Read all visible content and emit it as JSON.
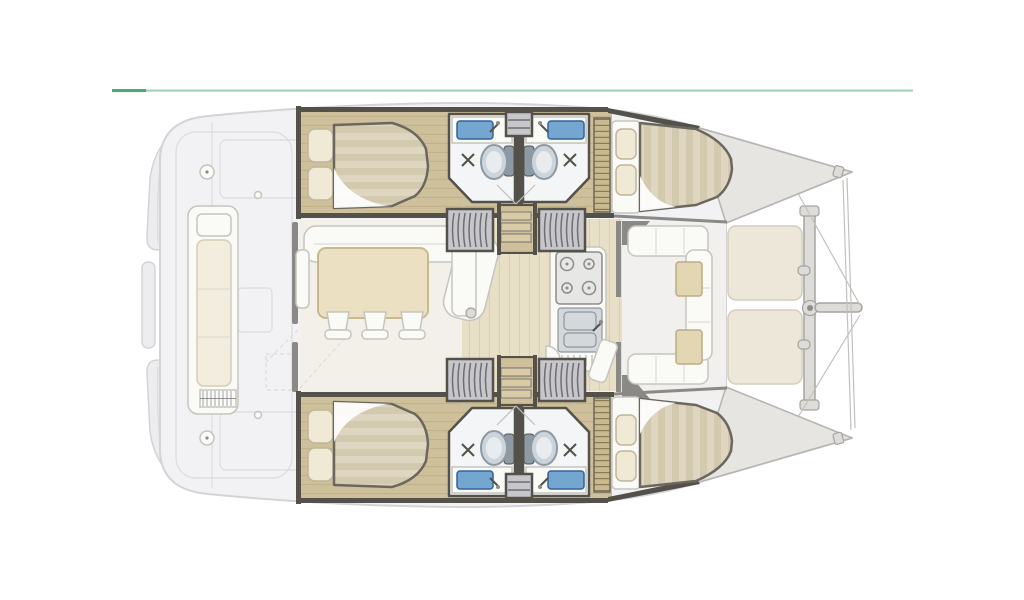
{
  "figure": {
    "kind": "catamaran-interior-floor-plan",
    "orientation": "bow-right",
    "hull_count": 2,
    "cabins": 4,
    "bathrooms": 4
  },
  "palette": {
    "accent_dark": "#3fae7c",
    "accent_light": "#a6d1b9",
    "deck": "#f2f2f4",
    "deck_stroke": "#d4d4d8",
    "transom": "#ededf0",
    "seam": "#dcdce0",
    "bulkhead": "#54514b",
    "wall_gray": "#8b8985",
    "wood": "#cec09b",
    "wood_stripe": "#c2b28a",
    "step": "#d8cba6",
    "step_stroke": "#7c7a76",
    "floor_pale": "#f2f0e9",
    "floor_wood": "#e8dfc7",
    "floor_wood_stripe": "#dccfb1",
    "cockpit_floor": "#f1f0ee",
    "furniture": "#fafaf7",
    "furniture_stroke": "#c6c4be",
    "furn_seam": "#dedcd6",
    "cushion": "#f2edde",
    "cushion_stroke": "#d4cdb6",
    "table_wood": "#ebe0c2",
    "table_stroke": "#c8b98f",
    "small_table": "#e3d6b2",
    "small_table_stroke": "#bdac83",
    "bath": "#f3f5f6",
    "sink_blue": "#74a6cf",
    "sink_stroke": "#31639c",
    "basin": "#d3d8db",
    "basin_stroke": "#8f969c",
    "toilet": "#ccd5dc",
    "toilet_stroke": "#8d99a3",
    "toilet_seat": "#e8ecef",
    "hatch": "#c7c7cb",
    "hatch_stripe": "#6e6e73",
    "tramp": "#ece7d8",
    "tramp_stroke": "#d4cdb9",
    "beam": "#dedcd8",
    "beam_stroke": "#a5a39f",
    "rigging": "#c3c1be",
    "bed_outline": "#6b675e",
    "mattress": "#ded6c1",
    "mattress_stripe": "#d3c9ae",
    "duvet": "#fdfdfc",
    "pillow": "#f0e9d6",
    "pillow_stroke": "#bfb69c",
    "bow": "#e7e5e2",
    "bow_stroke": "#b6b4b1",
    "locker": "#c9b98f",
    "locker_slat": "#8a7a54",
    "burner": "#e7e7e5",
    "burner_stroke": "#8e8c88"
  }
}
